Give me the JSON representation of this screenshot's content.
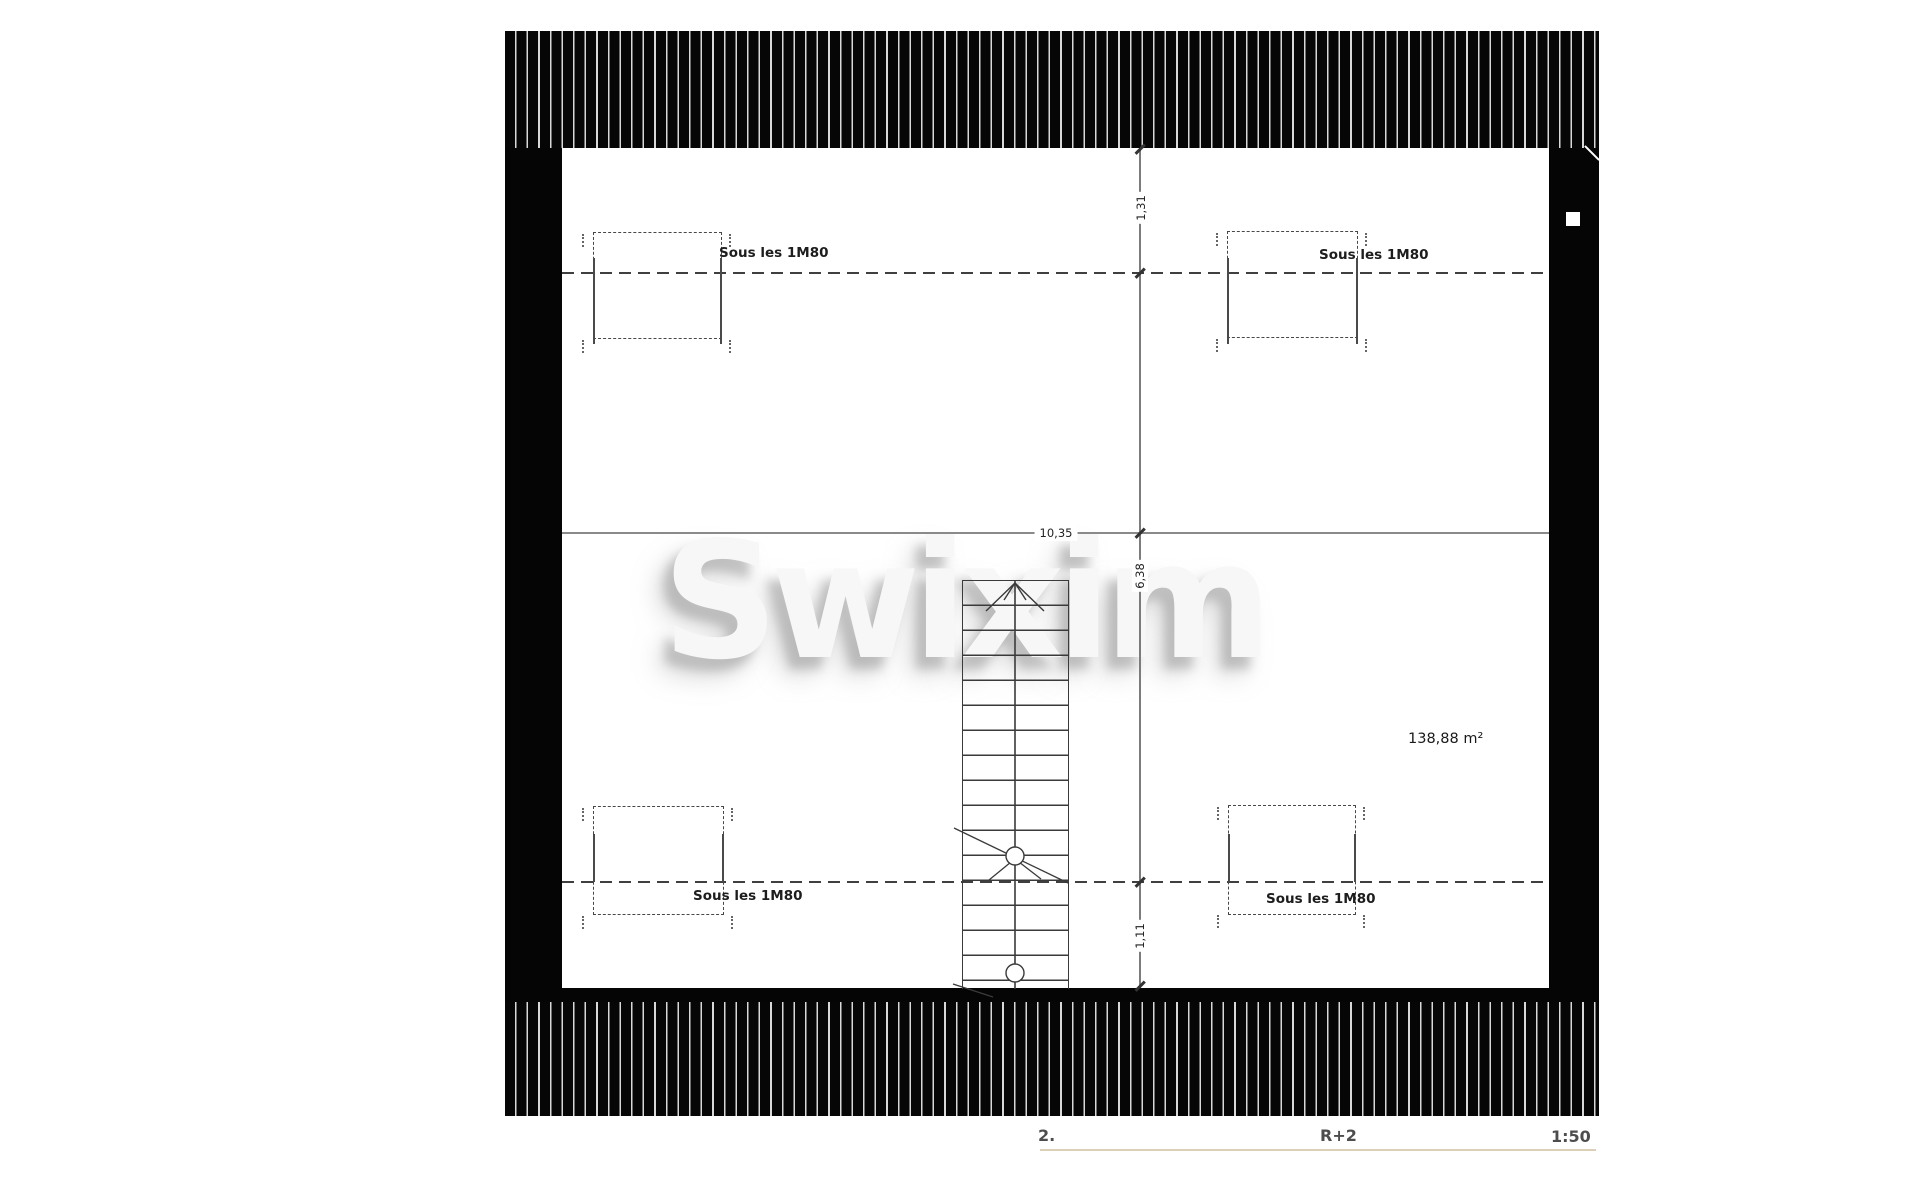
{
  "plan": {
    "watermark": "Swixim",
    "annotations": {
      "under_height_label": "Sous les 1M80",
      "area_label": "138,88 m²"
    },
    "dimensions": {
      "top_offset": "1,31",
      "width": "10,35",
      "middle_height": "6,38",
      "bottom_offset": "1,11"
    }
  },
  "footer": {
    "page_number": "2.",
    "floor_label": "R+2",
    "scale_label": "1:50"
  },
  "colors": {
    "wall": "#050505",
    "hatch_line": "#d8d8d8",
    "dimension_line": "#7c7c7c",
    "dashed_line": "#3f3f3f",
    "footer_text": "#4d4d4d",
    "footer_rule": "#dbd0b7"
  }
}
